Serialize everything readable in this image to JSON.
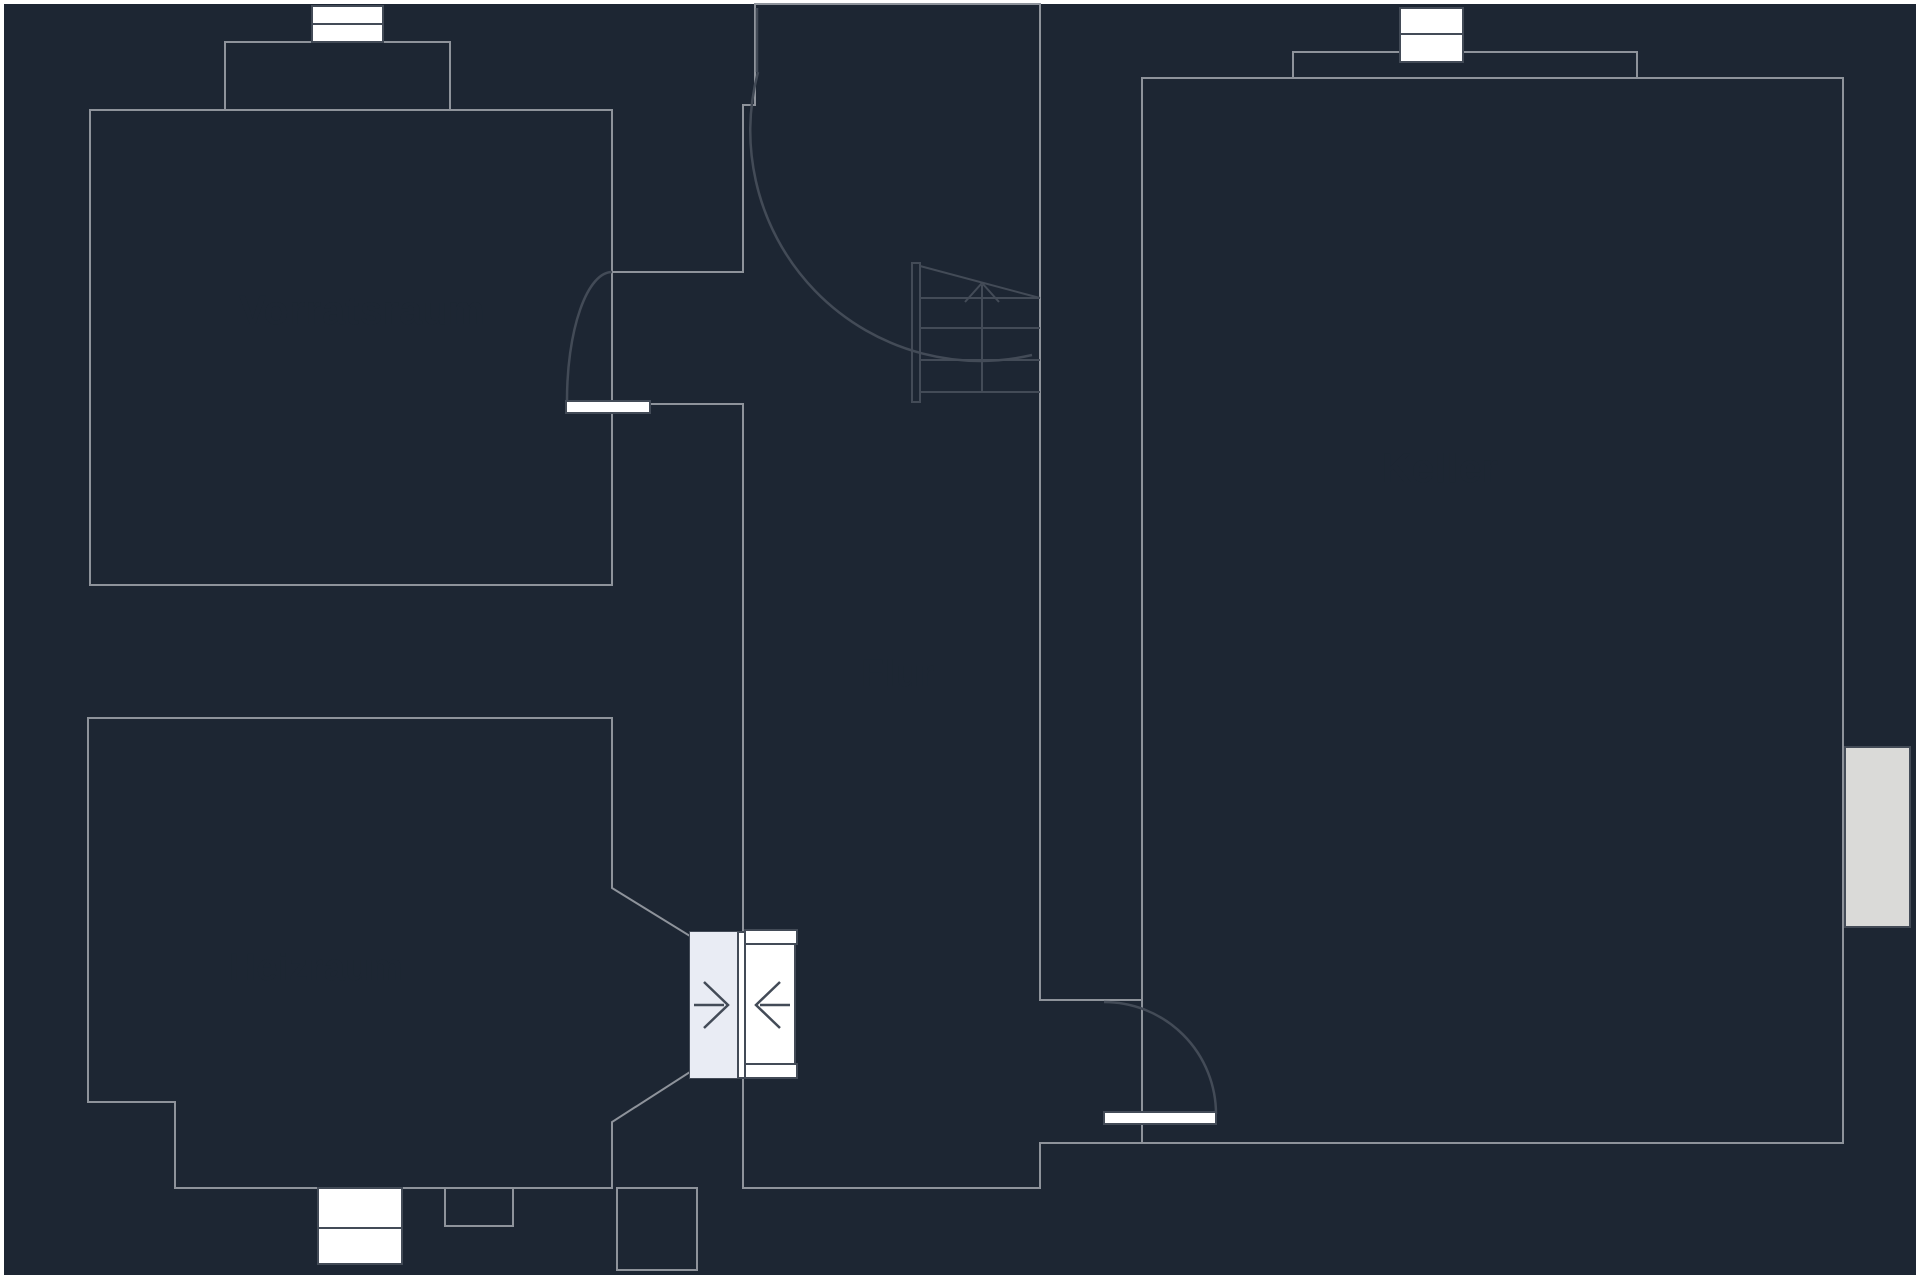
{
  "plan": {
    "type": "basement-floor-plan",
    "rooms": {
      "vorratsraum": {
        "label": "Vorratsraum"
      },
      "flur": {
        "label": "Flur"
      },
      "heizraum": {
        "label": "Heizraum"
      },
      "keller": {
        "label": "Keller"
      }
    }
  },
  "colors": {
    "page": "#ffffff",
    "wall": "#1d2633",
    "room": "#d6d6d4",
    "room_light": "#e9ecf4",
    "window": "#ffffff",
    "window_gray": "#dadad8",
    "outline": "#8e939b",
    "symbol_line": "#434b57",
    "label": "#1d2633"
  },
  "symbols": {
    "door_swing": "quarter-circle-arc",
    "stairs": "treads-with-up-arrow",
    "double_door": "opposing-chevron-arrows",
    "window": "white-rect-with-divider"
  }
}
